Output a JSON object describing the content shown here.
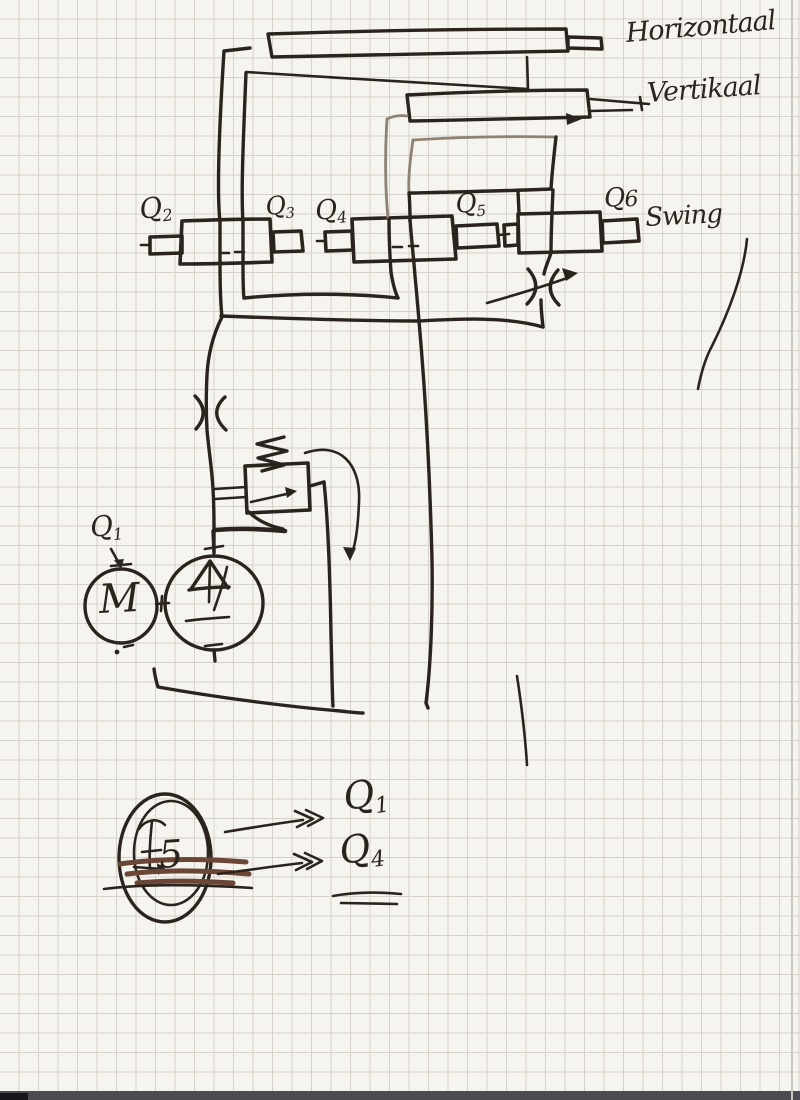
{
  "colors": {
    "ink": "#2b241e",
    "faded": "#8d8274",
    "brown": "#6b4636",
    "paper": "#f6f4ef",
    "grid": "#d5d2cb",
    "edge": "#4a4c52",
    "edgeCorner": "#15161a"
  },
  "annotations": {
    "horizontal": "Horizontaal",
    "vertical": "Vertikaal",
    "swing": "Swing"
  },
  "valve_labels": {
    "q2": {
      "base": "Q",
      "sub": "2"
    },
    "q3": {
      "base": "Q",
      "sub": "3"
    },
    "q4": {
      "base": "Q",
      "sub": "4"
    },
    "q5": {
      "base": "Q",
      "sub": "5"
    },
    "q6": {
      "base": "Q",
      "sub": "6"
    },
    "q1_pump": {
      "base": "Q",
      "sub": "1"
    }
  },
  "motor": {
    "letter": "M"
  },
  "legend": {
    "gauge_value": "5",
    "target_top": {
      "base": "Q",
      "sub": "1"
    },
    "target_bottom": {
      "base": "Q",
      "sub": "4"
    }
  }
}
